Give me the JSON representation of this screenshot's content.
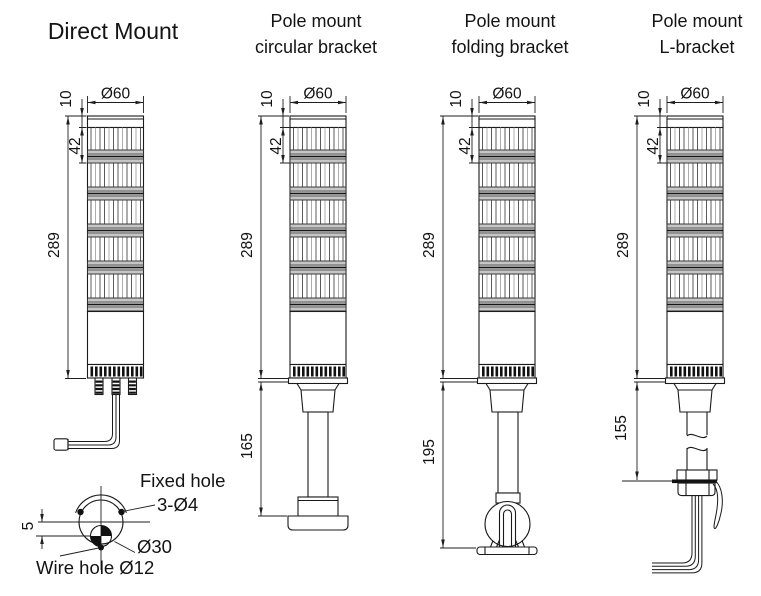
{
  "page": {
    "background": "#ffffff"
  },
  "columns": [
    {
      "id": "direct-mount",
      "title_lines": [
        "Direct Mount"
      ]
    },
    {
      "id": "pole-circular",
      "title_lines": [
        "Pole mount",
        "circular bracket"
      ]
    },
    {
      "id": "pole-folding",
      "title_lines": [
        "Pole mount",
        "folding bracket"
      ]
    },
    {
      "id": "pole-l",
      "title_lines": [
        "Pole mount",
        "L-bracket"
      ]
    }
  ],
  "dimensions": {
    "top_diameter": "Ø60",
    "cap_height": "10",
    "first_segment": "42",
    "body_height": "289",
    "pole_circular": "165",
    "pole_folding": "195",
    "pole_l": "155"
  },
  "bottom_view": {
    "offset": "5",
    "fixed_hole_label": "Fixed hole",
    "fixed_hole_spec": "3-Ø4",
    "flange_diameter": "Ø30",
    "wire_hole_label": "Wire hole Ø12"
  },
  "colors": {
    "line": "#1a1a1a",
    "dark_fill": "#111111",
    "band_gray": "#c6c6c6",
    "background": "#ffffff"
  }
}
